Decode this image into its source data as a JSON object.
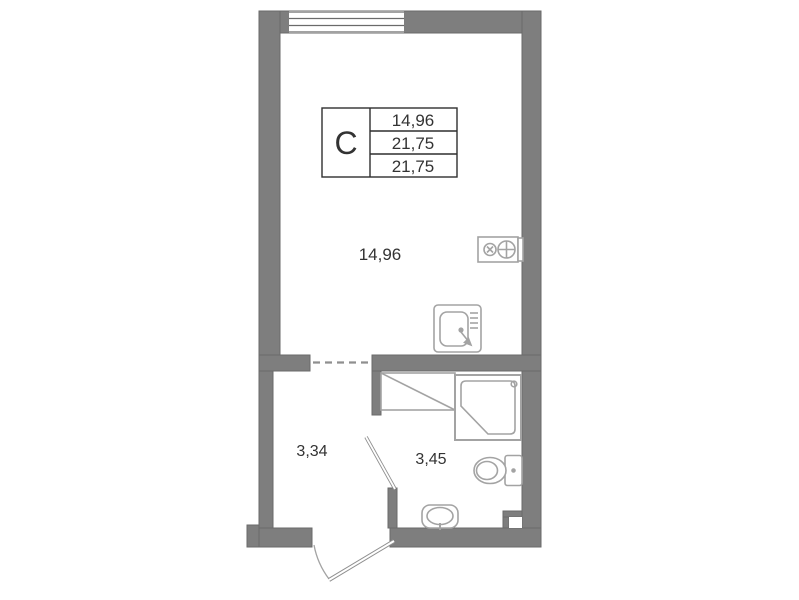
{
  "stamp": {
    "type_label": "С",
    "values": [
      "14,96",
      "21,75",
      "21,75"
    ]
  },
  "rooms": {
    "living": {
      "area": "14,96"
    },
    "hall": {
      "area": "3,34"
    },
    "bath": {
      "area": "3,45"
    }
  },
  "colors": {
    "wall_fill": "#7e7e7e",
    "wall_edge": "#6a6a6a",
    "fixture_stroke": "#a3a3a3",
    "detail_stroke": "#8f8f8f",
    "stamp_border": "#2f2f2f",
    "text": "#333333",
    "background": "#ffffff"
  }
}
